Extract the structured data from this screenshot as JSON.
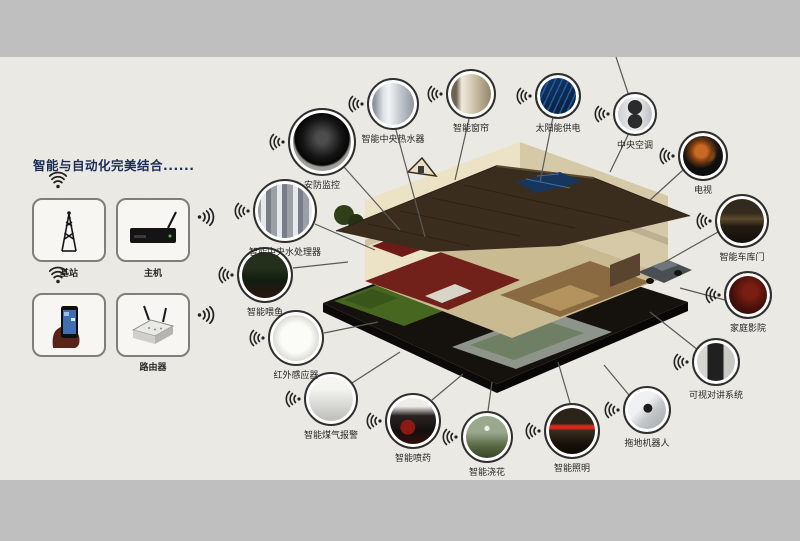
{
  "title": {
    "text": "智能与自动化完美结合......",
    "color": "#1a2c55"
  },
  "colors": {
    "surround": "#bfbfbf",
    "paper": "#edebe6",
    "connector_line": "#5a5a55",
    "label_text": "#262624",
    "circle_border": "#2f2f2d"
  },
  "hub": {
    "items": [
      {
        "label": "基站",
        "icon": "signal-tower-icon"
      },
      {
        "label": "主机",
        "icon": "set-top-box-icon"
      },
      {
        "label": "",
        "icon": "smartphone-in-hand-icon"
      },
      {
        "label": "路由器",
        "icon": "router-icon"
      }
    ]
  },
  "devices": [
    {
      "label": "安防监控",
      "icon": "dome-camera-photo"
    },
    {
      "label": "智能中央热水器",
      "icon": "water-heater-photo"
    },
    {
      "label": "智能窗帘",
      "icon": "curtains-photo"
    },
    {
      "label": "太阳能供电",
      "icon": "solar-panel-photo"
    },
    {
      "label": "中央空调",
      "icon": "ac-unit-photo"
    },
    {
      "label": "电视",
      "icon": "tv-photo"
    },
    {
      "label": "智能车库门",
      "icon": "garage-door-photo"
    },
    {
      "label": "家庭影院",
      "icon": "home-theater-photo"
    },
    {
      "label": "可视对讲系统",
      "icon": "intercom-photo"
    },
    {
      "label": "拖地机器人",
      "icon": "mopping-robot-photo"
    },
    {
      "label": "智能照明",
      "icon": "lighting-photo"
    },
    {
      "label": "智能浇花",
      "icon": "sprinkler-photo"
    },
    {
      "label": "智能喷药",
      "icon": "sprayer-boots-photo"
    },
    {
      "label": "智能煤气报警",
      "icon": "gas-alarm-photo"
    },
    {
      "label": "红外感应器",
      "icon": "infrared-sensor-photo"
    },
    {
      "label": "智能喂鱼",
      "icon": "fish-feeder-photo"
    },
    {
      "label": "智能中央水处理器",
      "icon": "water-processor-photo"
    }
  ]
}
